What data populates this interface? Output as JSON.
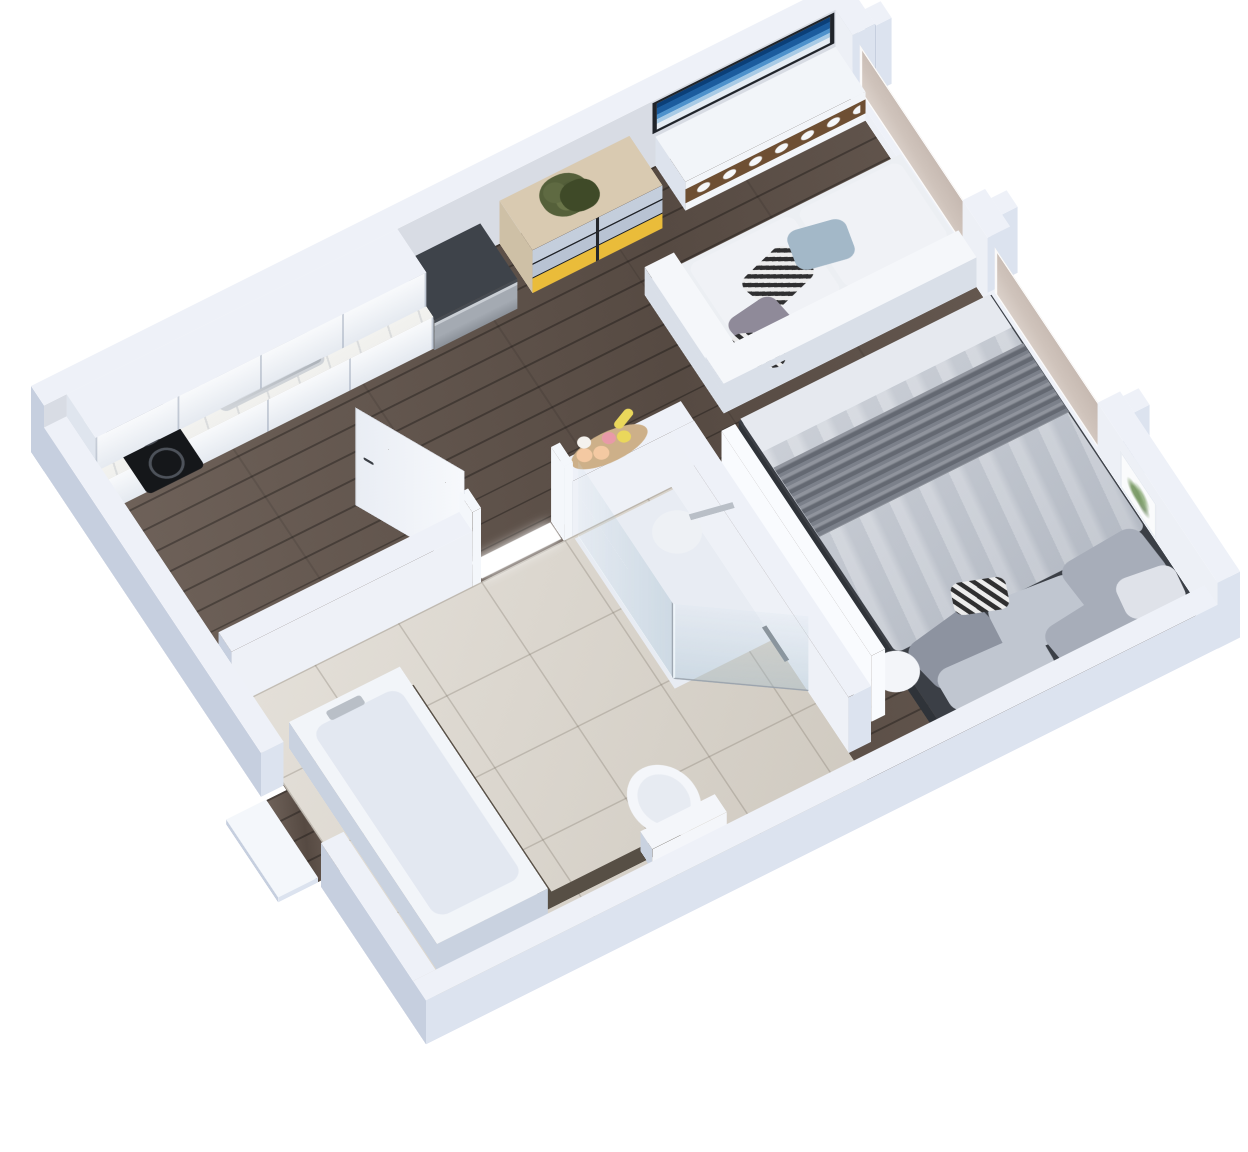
{
  "meta": {
    "title": "3D isometric rendering of a studio apartment floor plan",
    "view": "axonometric top-down cutaway, no visible text labels"
  },
  "palette": {
    "bg": "#ffffff",
    "wallTop": "#eef1f8",
    "wallSouth": "#dce3ef",
    "wallWest": "#c6cfdf",
    "wallInnerBack": "#d8dce4",
    "wallInnerRight": "#edf0f6",
    "showerWall": "#eef1f7",
    "showerFloor": "#e8ecf3",
    "panelBright": "#f9fbfe",
    "doorWhite": "#f4f7fb",
    "tubWhite": "#f2f5f9",
    "tubInner": "#e3e8f1",
    "tubShadow": "#c9d2e0",
    "toiletWhite": "#f4f6fa",
    "seatGray": "#e7ebf2",
    "vanityDark": "#574f45",
    "steel": "#b9bfc7",
    "steelDark": "#7b8289",
    "dwTop": "#3e434a",
    "cabWest": "#dfe5ee",
    "wood": "#64564d",
    "tile": "#d8d2c8",
    "marble": "#f5f5f2",
    "cabFront": "#f1f4f8",
    "dresserTop": "#d9cab1",
    "dresserSide": "#cec0a6",
    "drawerBlue": "#c4cedc",
    "drawerBlue2": "#b8c3d3",
    "drawerYellow": "#eabc3a",
    "consoleWhite": "#f2f5f9",
    "consoleShadow": "#dde3ed",
    "woodNiche": "#6e4f33",
    "tvFrame": "#20242a",
    "sofaTop": "#eceff3",
    "sofaShade": "#d9dfe8",
    "sofaBack": "#f5f7fa",
    "sofaCushion": "#f0f2f6",
    "pillowBlue": "#a3b8c8",
    "pillowMauve": "#8f8a99",
    "bedBase": "#3b3f46",
    "bedBaseDark": "#2f3339",
    "duvet": "#c8cdd6",
    "duvetFold": "#e6e9ef",
    "throw": "#7b808a",
    "pillow1": "#a7adb9",
    "pillow2": "#c0c6d0",
    "pillow3": "#8d93a0",
    "pillowWhite": "#dfe2e9",
    "canister": "#c8a878",
    "basketTan": "#cdb089",
    "fruitPeach": "#f4c9a2",
    "fruitPink": "#e89aa8",
    "fruitYellow": "#ead75b",
    "fruitWhite": "#f4f2ee",
    "tableWhite": "#f3f5f9",
    "showerHead": "#eef1f5",
    "cooktop": "#15171a",
    "lightGlow": "#ffffff",
    "plantDark": "#3f4a28"
  },
  "scene": {
    "left": 31,
    "top": 452,
    "rotate_x_deg": 30,
    "rotate_z_deg": -30,
    "plan_width": 940,
    "plan_depth": 790
  },
  "flats": [
    {
      "name": "wood-floor",
      "x": 26,
      "y": 26,
      "w": 888,
      "d": 738,
      "z": 0,
      "c": ".wood"
    },
    {
      "name": "entry-threshold-floor",
      "x": 0,
      "y": 466,
      "w": 26,
      "d": 108,
      "z": 0.5,
      "c": ".wood"
    },
    {
      "name": "bathroom-tile-floor",
      "x": 26,
      "y": 356,
      "w": 508,
      "d": 408,
      "z": 2,
      "c": ".tile"
    },
    {
      "name": "shower-floor",
      "x": 420,
      "y": 360,
      "w": 114,
      "d": 200,
      "z": 3,
      "c": "showerFloor"
    },
    {
      "name": "doorway-light-sill",
      "x": 316,
      "y": 332,
      "w": 92,
      "d": 22,
      "z": 4,
      "c": "lightGlow",
      "cls2": "glow"
    },
    {
      "name": "tub-deck-strip",
      "x": 182,
      "y": 426,
      "w": 14,
      "d": 292,
      "z": 4,
      "c": "vanityDark"
    },
    {
      "name": "tub-deck-strip-foot",
      "x": 182,
      "y": 702,
      "w": 158,
      "d": 16,
      "z": 4.5,
      "c": "vanityDark"
    },
    {
      "name": "tub-inner-basin",
      "x": 66,
      "y": 446,
      "w": 100,
      "d": 252,
      "z": 56,
      "r": 14,
      "c": "tubInner"
    },
    {
      "name": "tub-faucet",
      "x": 88,
      "y": 436,
      "w": 40,
      "d": 12,
      "z": 58,
      "c": "steel",
      "r": 3
    },
    {
      "name": "toilet-bowl",
      "x": 304,
      "y": 636,
      "w": 70,
      "d": 86,
      "z": 28,
      "r": "50%",
      "c": "toiletWhite"
    },
    {
      "name": "toilet-seat",
      "x": 314,
      "y": 648,
      "w": 50,
      "d": 62,
      "z": 29,
      "r": "50%",
      "c": "seatGray"
    },
    {
      "name": "shower-head",
      "x": 448,
      "y": 448,
      "w": 50,
      "d": 50,
      "z": 140,
      "r": "50%",
      "c": "showerHead"
    },
    {
      "name": "shower-arm",
      "x": 492,
      "y": 466,
      "w": 46,
      "d": 7,
      "z": 140,
      "rot": 12,
      "c": "steel"
    },
    {
      "name": "hand-shower-hose",
      "x": 523,
      "y": 556,
      "w": 5,
      "d": 46,
      "z": 30,
      "c": "steelDark"
    },
    {
      "name": "cooktop",
      "x": 58,
      "y": 34,
      "w": 66,
      "d": 100,
      "z": 65,
      "r": 6,
      "c": "cooktop"
    },
    {
      "name": "cooktop-burner-rear",
      "x": 70,
      "y": 44,
      "w": 42,
      "d": 42,
      "z": 66,
      "r": "50%",
      "c": ".ring"
    },
    {
      "name": "cooktop-burner-front",
      "x": 74,
      "y": 94,
      "w": 36,
      "d": 36,
      "z": 66,
      "r": "50%",
      "c": ".ring"
    },
    {
      "name": "kitchen-sink",
      "x": 170,
      "y": 32,
      "w": 120,
      "d": 58,
      "z": 65,
      "r": 8,
      "c": ".sink-steel"
    },
    {
      "name": "kitchen-sink-bowl",
      "x": 184,
      "y": 40,
      "w": 92,
      "d": 44,
      "z": 66,
      "r": 8,
      "c": ".sink-bowl"
    },
    {
      "name": "kitchen-faucet",
      "x": 150,
      "y": 42,
      "w": 36,
      "d": 7,
      "z": 67,
      "rot": -30,
      "c": "steel",
      "r": 3
    },
    {
      "name": "canister-1",
      "x": 246,
      "y": 34,
      "w": 20,
      "d": 20,
      "z": 66,
      "r": "50%",
      "c": "canister"
    },
    {
      "name": "canister-2",
      "x": 268,
      "y": 28,
      "w": 20,
      "d": 20,
      "z": 66,
      "r": "50%",
      "c": "canister"
    },
    {
      "name": "canister-3",
      "x": 290,
      "y": 24,
      "w": 20,
      "d": 20,
      "z": 66,
      "r": "50%",
      "c": "canister"
    },
    {
      "name": "dresser-plant-foliage",
      "x": 560,
      "y": 30,
      "w": 52,
      "d": 48,
      "z": 88,
      "r": "46%",
      "c": ".plant"
    },
    {
      "name": "dresser-plant-foliage-2",
      "x": 578,
      "y": 44,
      "w": 40,
      "d": 36,
      "z": 89,
      "r": "46%",
      "c": "plantDark"
    },
    {
      "name": "sofa-cushion-left",
      "x": 664,
      "y": 162,
      "w": 120,
      "d": 104,
      "z": 40,
      "r": 10,
      "c": "sofaCushion"
    },
    {
      "name": "sofa-cushion-right",
      "x": 790,
      "y": 162,
      "w": 118,
      "d": 104,
      "z": 40,
      "r": 10,
      "c": "sofaCushion"
    },
    {
      "name": "sofa-pillow-striped",
      "x": 702,
      "y": 196,
      "w": 66,
      "d": 50,
      "z": 44,
      "rot": -18,
      "r": 12,
      "c": ".stripes"
    },
    {
      "name": "sofa-pillow-blue",
      "x": 760,
      "y": 186,
      "w": 62,
      "d": 48,
      "z": 45,
      "rot": 12,
      "r": 12,
      "c": "pillowBlue"
    },
    {
      "name": "sofa-pillow-mauve",
      "x": 664,
      "y": 236,
      "w": 58,
      "d": 46,
      "z": 45,
      "rot": -8,
      "r": 12,
      "c": "pillowMauve"
    },
    {
      "name": "sofa-pillow-striped-2",
      "x": 648,
      "y": 264,
      "w": 54,
      "d": 42,
      "z": 46,
      "rot": 26,
      "r": 12,
      "c": ".stripes"
    },
    {
      "name": "bed-duvet",
      "x": 624,
      "y": 338,
      "w": 288,
      "d": 312,
      "z": 32,
      "r": 8,
      "c": ".duvet"
    },
    {
      "name": "bed-sheet-fold",
      "x": 624,
      "y": 338,
      "w": 288,
      "d": 44,
      "z": 33,
      "c": "duvetFold"
    },
    {
      "name": "bed-throw-blanket",
      "x": 624,
      "y": 404,
      "w": 288,
      "d": 92,
      "z": 34,
      "c": ".pleats"
    },
    {
      "name": "bed-pillow-1",
      "x": 634,
      "y": 644,
      "w": 92,
      "d": 66,
      "z": 36,
      "rot": -10,
      "r": 16,
      "c": "pillow3"
    },
    {
      "name": "bed-pillow-2",
      "x": 722,
      "y": 652,
      "w": 98,
      "d": 68,
      "z": 36,
      "rot": 6,
      "r": 16,
      "c": "pillow2"
    },
    {
      "name": "bed-pillow-3",
      "x": 812,
      "y": 644,
      "w": 94,
      "d": 70,
      "z": 36,
      "rot": -4,
      "r": 16,
      "c": "pillow1"
    },
    {
      "name": "bed-pillow-4",
      "x": 640,
      "y": 694,
      "w": 116,
      "d": 54,
      "z": 37,
      "rot": 3,
      "r": 16,
      "c": "pillow2"
    },
    {
      "name": "bed-pillow-5",
      "x": 760,
      "y": 698,
      "w": 110,
      "d": 56,
      "z": 37,
      "rot": -6,
      "r": 16,
      "c": "pillow1"
    },
    {
      "name": "bed-pillow-striped",
      "x": 700,
      "y": 618,
      "w": 56,
      "d": 38,
      "z": 37,
      "rot": 20,
      "r": 10,
      "c": ".stripes"
    },
    {
      "name": "bed-pillow-white",
      "x": 846,
      "y": 694,
      "w": 64,
      "d": 50,
      "z": 38,
      "rot": 8,
      "r": 14,
      "c": "pillowWhite"
    },
    {
      "name": "bedside-table",
      "x": 588,
      "y": 646,
      "w": 48,
      "d": 48,
      "z": 36,
      "r": "50%",
      "c": "tableWhite"
    },
    {
      "name": "fruit-basket",
      "x": 428,
      "y": 324,
      "w": 86,
      "d": 34,
      "z": 114,
      "r": "50%",
      "c": "basketTan"
    },
    {
      "name": "fruit-peach-1",
      "x": 436,
      "y": 330,
      "w": 16,
      "d": 16,
      "z": 116,
      "r": "50%",
      "c": "fruitPeach"
    },
    {
      "name": "fruit-peach-2",
      "x": 452,
      "y": 336,
      "w": 16,
      "d": 16,
      "z": 116,
      "r": "50%",
      "c": "fruitPeach"
    },
    {
      "name": "fruit-pink",
      "x": 468,
      "y": 326,
      "w": 14,
      "d": 14,
      "z": 116,
      "r": "50%",
      "c": "fruitPink"
    },
    {
      "name": "fruit-yellow",
      "x": 482,
      "y": 332,
      "w": 14,
      "d": 14,
      "z": 116,
      "r": "50%",
      "c": "fruitYellow"
    },
    {
      "name": "fruit-white",
      "x": 444,
      "y": 318,
      "w": 14,
      "d": 14,
      "z": 116,
      "r": "50%",
      "c": "fruitWhite"
    },
    {
      "name": "fruit-banana",
      "x": 486,
      "y": 316,
      "w": 26,
      "d": 10,
      "z": 116,
      "rot": -25,
      "r": 8,
      "c": "fruitYellow"
    }
  ],
  "boxes": [
    {
      "name": "back-wall",
      "x": 0,
      "y": 0,
      "w": 940,
      "d": 26,
      "h": 132,
      "top": "wallTop",
      "south": "wallInnerBack",
      "west": "wallWest"
    },
    {
      "name": "right-wall-segment-a",
      "x": 914,
      "y": 0,
      "w": 26,
      "d": 60,
      "h": 132,
      "top": "wallTop",
      "south": "wallSouth",
      "west": "wallInnerRight"
    },
    {
      "name": "window-sill-1",
      "x": 914,
      "y": 60,
      "w": 26,
      "d": 220,
      "h": 22,
      "top": "wallTop",
      "south": "wallSouth",
      "west": "wallInnerRight"
    },
    {
      "name": "right-wall-segment-b",
      "x": 914,
      "y": 280,
      "w": 26,
      "d": 50,
      "h": 132,
      "top": "wallTop",
      "south": "wallSouth",
      "west": "wallInnerRight"
    },
    {
      "name": "window-sill-2",
      "x": 914,
      "y": 330,
      "w": 26,
      "d": 220,
      "h": 22,
      "top": "wallTop",
      "south": "wallSouth",
      "west": "wallInnerRight"
    },
    {
      "name": "right-wall-segment-c",
      "x": 914,
      "y": 550,
      "w": 26,
      "d": 240,
      "h": 132,
      "top": "wallTop",
      "south": "wallSouth",
      "west": "wallInnerRight"
    },
    {
      "name": "window-mullion-stub-1",
      "x": 940,
      "y": 40,
      "w": 18,
      "d": 22,
      "h": 132,
      "top": "wallTop",
      "south": "wallSouth",
      "west": "wallWest"
    },
    {
      "name": "window-mullion-stub-2",
      "x": 940,
      "y": 292,
      "w": 18,
      "d": 22,
      "h": 132,
      "top": "wallTop",
      "south": "wallSouth",
      "west": "wallWest"
    },
    {
      "name": "window-mullion-stub-3",
      "x": 940,
      "y": 556,
      "w": 18,
      "d": 22,
      "h": 132,
      "top": "wallTop",
      "south": "wallSouth",
      "west": "wallWest"
    },
    {
      "name": "front-wall",
      "x": 0,
      "y": 764,
      "w": 940,
      "d": 26,
      "h": 88,
      "top": "wallTop",
      "south": "wallSouth",
      "west": "wallWest"
    },
    {
      "name": "left-wall-upper",
      "x": 0,
      "y": 26,
      "w": 26,
      "d": 434,
      "h": 88,
      "top": "wallTop",
      "south": "wallSouth",
      "west": "wallWest"
    },
    {
      "name": "left-wall-lower",
      "x": 0,
      "y": 580,
      "w": 26,
      "d": 184,
      "h": 88,
      "top": "wallTop",
      "south": "wallSouth",
      "west": "wallWest"
    },
    {
      "name": "entry-step",
      "x": -46,
      "y": 470,
      "w": 46,
      "d": 104,
      "h": 10,
      "top": "doorWhite",
      "south": "wallSouth",
      "west": "wallWest"
    },
    {
      "name": "bathroom-wall-top-left",
      "x": 26,
      "y": 330,
      "w": 278,
      "d": 26,
      "h": 112,
      "top": "wallTop",
      "south": "showerWall",
      "west": "wallWest"
    },
    {
      "name": "door-jamb-left",
      "x": 304,
      "y": 330,
      "w": 10,
      "d": 26,
      "h": 150,
      "top": "doorWhite",
      "south": "doorWhite",
      "west": "doorWhite"
    },
    {
      "name": "door-jamb-right",
      "x": 410,
      "y": 330,
      "w": 10,
      "d": 26,
      "h": 150,
      "top": "doorWhite",
      "south": "doorWhite",
      "west": "doorWhite"
    },
    {
      "name": "bathroom-ledge-wall",
      "x": 420,
      "y": 330,
      "w": 140,
      "d": 26,
      "h": 112,
      "top": "wallTop",
      "south": "showerWall",
      "west": "wallWest"
    },
    {
      "name": "bathroom-divider-wall",
      "x": 534,
      "y": 356,
      "w": 26,
      "d": 354,
      "h": 112,
      "top": "wallTop",
      "south": "wallSouth",
      "west": "showerWall"
    },
    {
      "name": "wardrobe-panel",
      "x": 572,
      "y": 390,
      "w": 16,
      "d": 300,
      "h": 132,
      "top": "panelBright",
      "south": "panelBright",
      "west": "panelBright"
    },
    {
      "name": "bathtub",
      "x": 52,
      "y": 426,
      "w": 128,
      "d": 296,
      "h": 54,
      "top": "tubWhite",
      "south": "tubShadow",
      "west": "tubShadow"
    },
    {
      "name": "toilet-tank",
      "x": 296,
      "y": 706,
      "w": 86,
      "d": 24,
      "h": 44,
      "top": "toiletWhite",
      "south": "toiletWhite",
      "west": "tubShadow"
    },
    {
      "name": "kitchen-upper-cabinets",
      "x": 26,
      "y": 26,
      "w": 382,
      "d": 58,
      "h": 72,
      "z": 60,
      "top": "wallTop",
      "south": ".cab-doors",
      "west": "cabWest"
    },
    {
      "name": "kitchen-counter",
      "x": 26,
      "y": 26,
      "w": 382,
      "d": 72,
      "h": 64,
      "top": ".marble",
      "south": ".cab-doors",
      "west": "cabWest"
    },
    {
      "name": "dishwasher",
      "x": 408,
      "y": 26,
      "w": 96,
      "d": 74,
      "h": 60,
      "top": "dwTop",
      "south": ".steel-front",
      "west": "steelDark"
    },
    {
      "name": "dresser",
      "x": 526,
      "y": 26,
      "w": 150,
      "d": 66,
      "h": 86,
      "top": "dresserTop",
      "south": ".dresser-front",
      "west": "dresserSide"
    },
    {
      "name": "media-console",
      "x": 706,
      "y": 26,
      "w": 208,
      "d": 60,
      "h": 58,
      "top": "consoleWhite",
      "south": ".console-front",
      "west": "consoleShadow"
    },
    {
      "name": "sofa-base",
      "x": 622,
      "y": 156,
      "w": 292,
      "d": 150,
      "h": 38,
      "top": "sofaTop",
      "south": "sofaShade",
      "west": "sofaShade"
    },
    {
      "name": "sofa-backrest",
      "x": 622,
      "y": 272,
      "w": 292,
      "d": 36,
      "h": 60,
      "top": "sofaBack",
      "south": "sofaShade",
      "west": "sofaShade"
    },
    {
      "name": "sofa-armrest",
      "x": 622,
      "y": 150,
      "w": 34,
      "d": 156,
      "h": 56,
      "top": "sofaBack",
      "south": "sofaShade",
      "west": "sofaShade"
    },
    {
      "name": "bed-base",
      "x": 622,
      "y": 338,
      "w": 292,
      "d": 404,
      "h": 30,
      "top": "bedBase",
      "south": "bedBaseDark",
      "west": "bedBaseDark"
    }
  ],
  "faces": [
    {
      "name": "tv-artwork",
      "type": "y",
      "x": 702,
      "y": 27,
      "len": 210,
      "h": 62,
      "z": 68,
      "c": ".tv"
    },
    {
      "name": "window-glass-1",
      "type": "x",
      "x": 920,
      "y": 64,
      "len": 212,
      "h": 92,
      "z": 22,
      "c": ".glass-window"
    },
    {
      "name": "window-glass-2",
      "type": "x",
      "x": 920,
      "y": 334,
      "len": 212,
      "h": 92,
      "z": 22,
      "c": ".glass-window"
    },
    {
      "name": "wall-art-frame",
      "type": "x",
      "x": 912,
      "y": 598,
      "len": 74,
      "h": 72,
      "z": 40,
      "c": ".art"
    },
    {
      "name": "shower-glass-side",
      "type": "x",
      "x": 424,
      "y": 360,
      "len": 190,
      "h": 150,
      "z": 4,
      "c": ".glass"
    },
    {
      "name": "shower-glass-angled",
      "type": "y",
      "x": 424,
      "y": 550,
      "rot": 36,
      "len": 136,
      "h": 150,
      "z": 4,
      "c": ".glass"
    },
    {
      "name": "bathroom-door-leaf",
      "type": "y",
      "x": 308,
      "y": 334,
      "rot": -116,
      "len": 132,
      "h": 196,
      "z": 0,
      "c": ".door"
    }
  ]
}
